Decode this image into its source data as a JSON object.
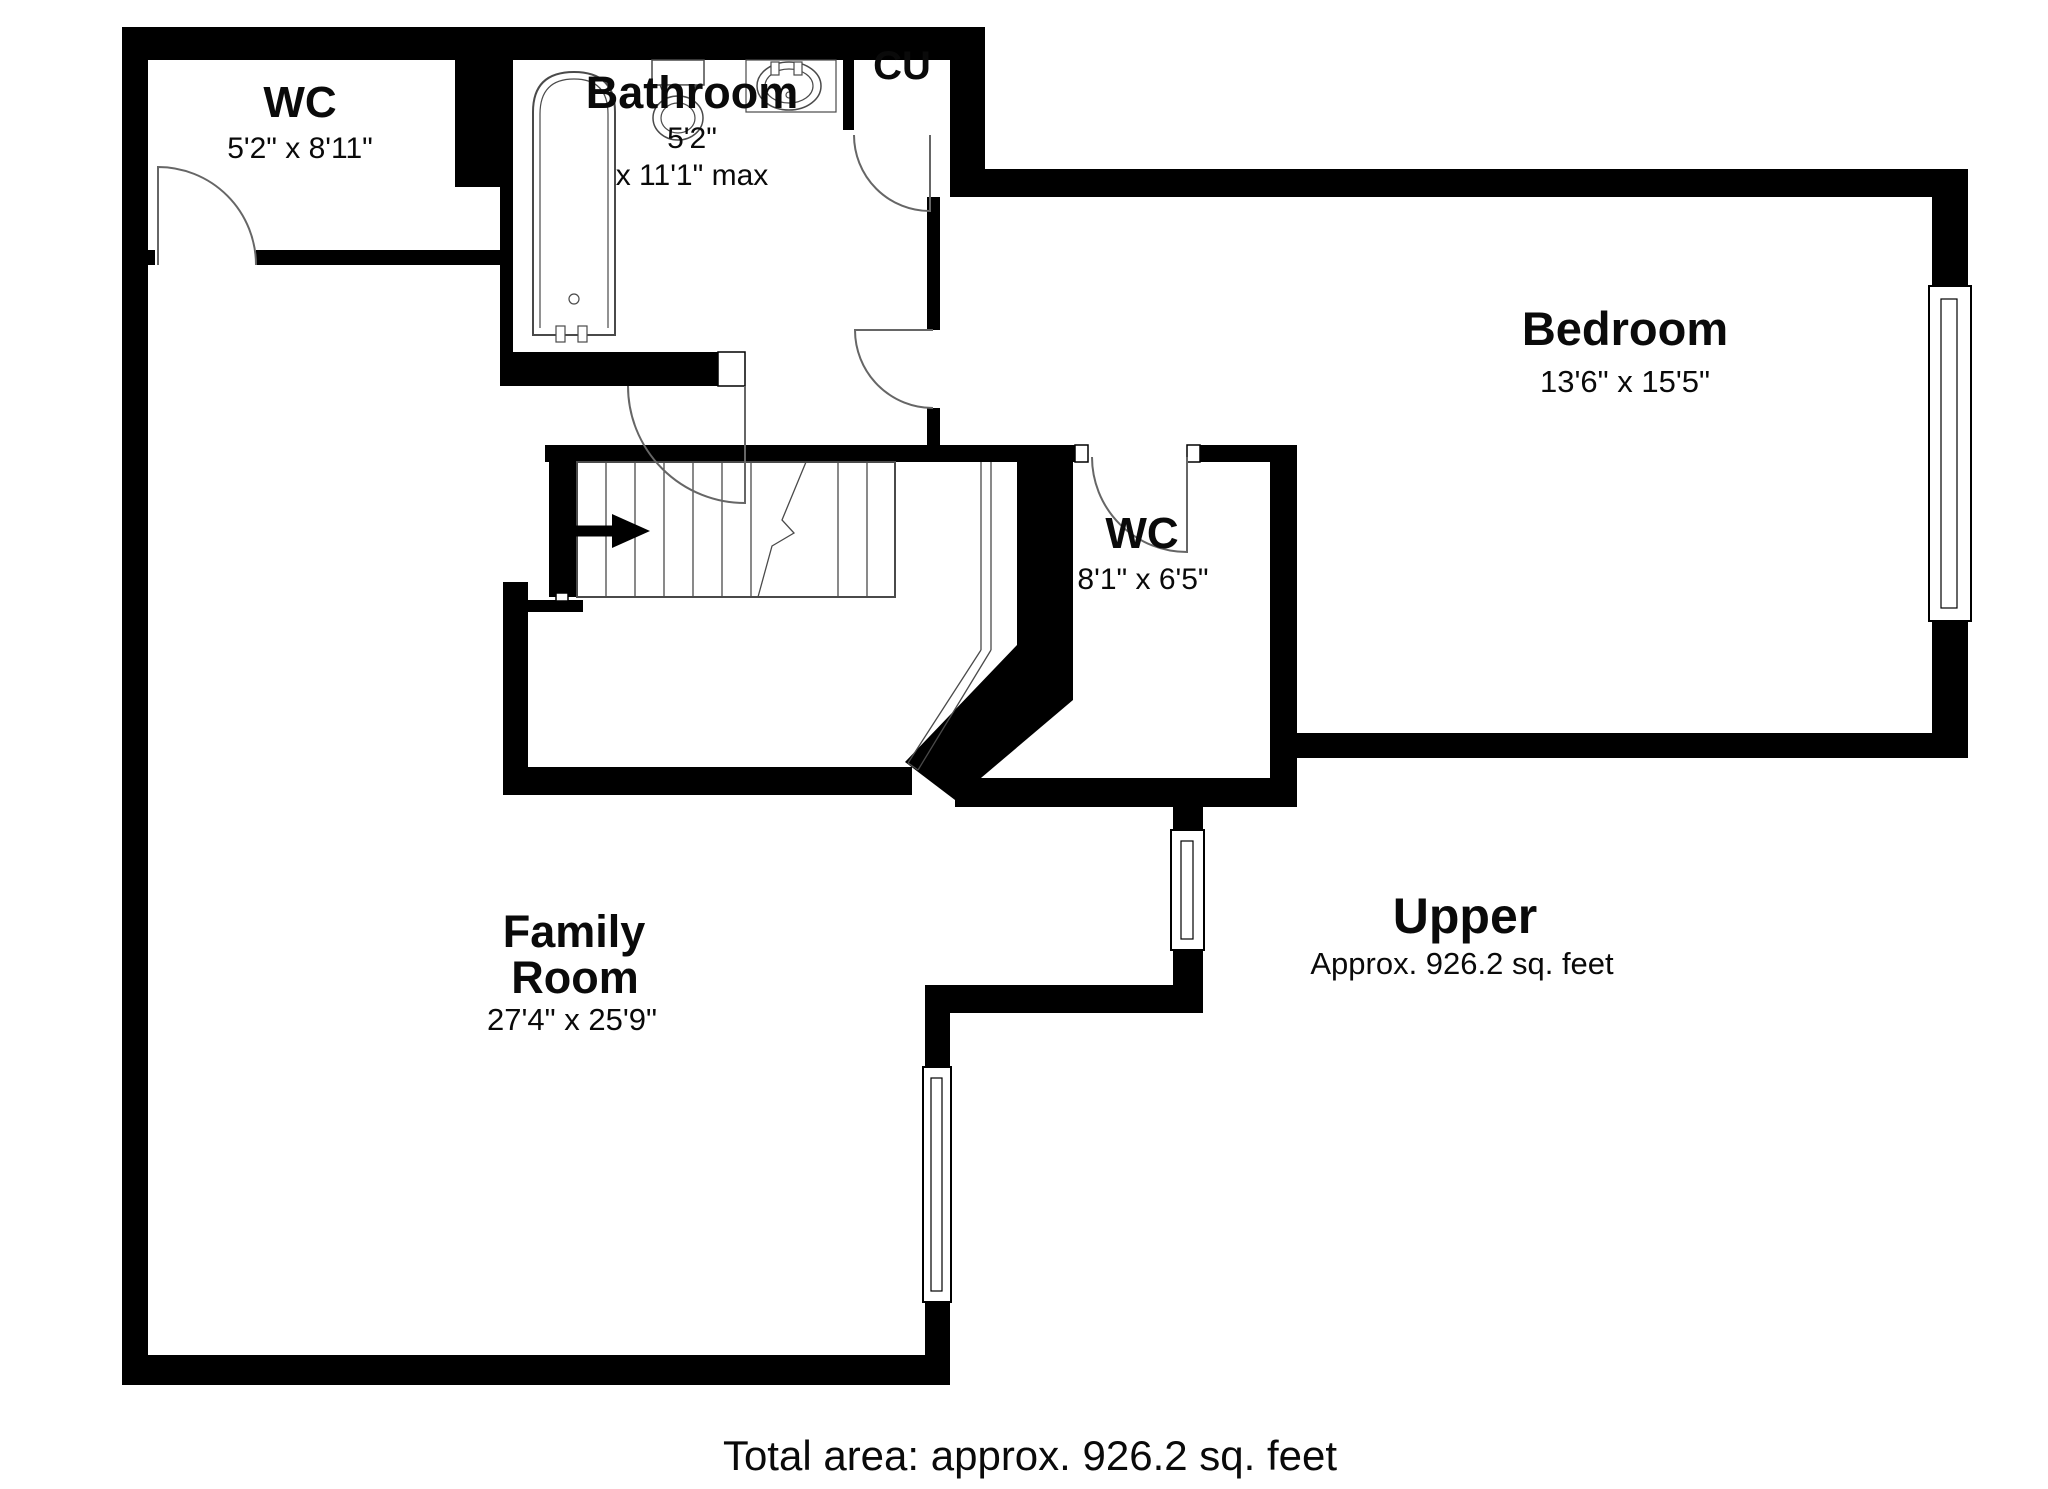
{
  "floor_plan": {
    "rooms": {
      "wc_top": {
        "name": "WC",
        "dims": "5'2\" x 8'11\""
      },
      "bathroom": {
        "name": "Bathroom",
        "dims_line1": "5'2\"",
        "dims_line2": "x 11'1\" max"
      },
      "cu": {
        "name": "CU"
      },
      "bedroom": {
        "name": "Bedroom",
        "dims": "13'6\" x 15'5\""
      },
      "wc_mid": {
        "name": "WC",
        "dims": "8'1\" x 6'5\""
      },
      "family": {
        "name_line1": "Family",
        "name_line2": "Room",
        "dims": "27'4\" x 25'9\""
      }
    },
    "floor_label": {
      "title": "Upper",
      "area": "Approx. 926.2 sq. feet"
    },
    "footer": "Total area: approx. 926.2 sq. feet",
    "colors": {
      "wall": "#000000",
      "line": "#4a4a4a",
      "door": "#666666",
      "background": "#ffffff",
      "text": "#0a0a0a"
    }
  }
}
